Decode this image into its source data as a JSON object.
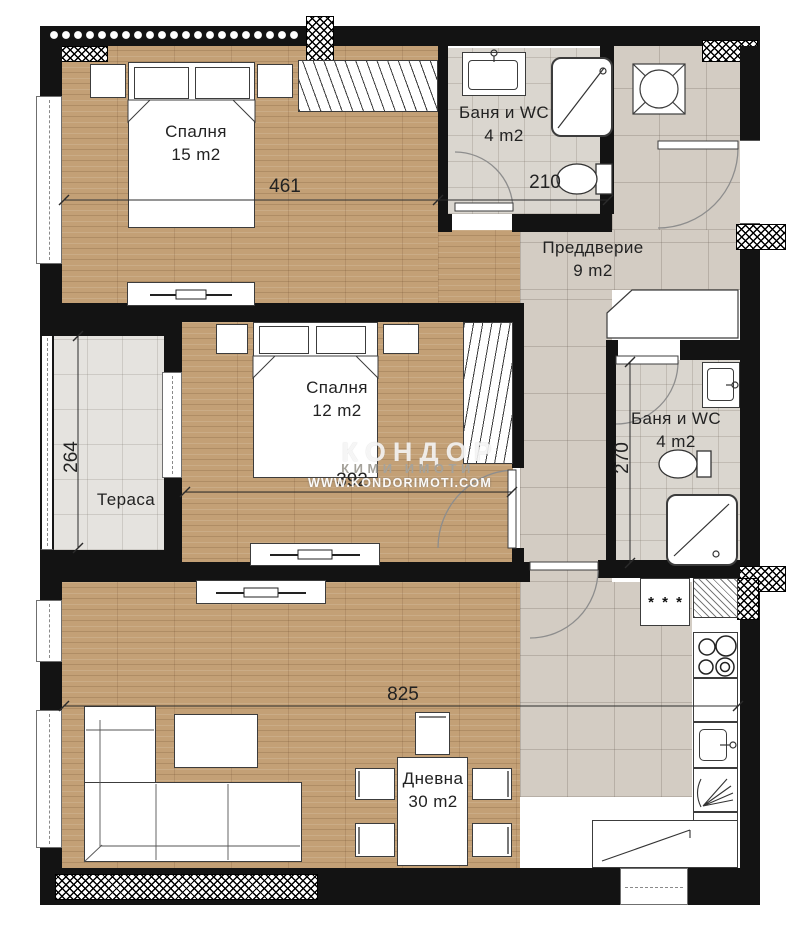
{
  "plan": {
    "title": "Apartment floor plan",
    "rooms": [
      {
        "id": "bedroom-1",
        "label": "Спалня",
        "area": "15 m2"
      },
      {
        "id": "bathroom-1",
        "label": "Баня и WC",
        "area": "4 m2"
      },
      {
        "id": "hallway",
        "label": "Преддверие",
        "area": "9 m2"
      },
      {
        "id": "bedroom-2",
        "label": "Спалня",
        "area": "12 m2"
      },
      {
        "id": "terrace",
        "label": "Тераса",
        "area": ""
      },
      {
        "id": "bathroom-2",
        "label": "Баня и WC",
        "area": "4 m2"
      },
      {
        "id": "living-room",
        "label": "Дневна",
        "area": "30 m2"
      }
    ],
    "dimensions": [
      {
        "id": "bedroom1-width",
        "value": "461"
      },
      {
        "id": "bathroom1-width",
        "value": "210"
      },
      {
        "id": "terrace-height",
        "value": "264"
      },
      {
        "id": "bedroom2-width",
        "value": "392"
      },
      {
        "id": "bathroom2-height",
        "value": "270"
      },
      {
        "id": "living-width",
        "value": "825"
      }
    ],
    "kitchen": {
      "freezer_symbol": "* * *"
    },
    "watermark": {
      "brand": "КОНДОР",
      "tagline": "КИМИ ИМОТИ",
      "website": "WWW.KONDORIMOTI.COM"
    },
    "colors": {
      "wall": "#131313",
      "wood_floor": "#c3a076",
      "hall_tile": "#d3ccc3",
      "bath_tile": "#dad6cf",
      "terrace_tile": "#e5e3df"
    }
  }
}
